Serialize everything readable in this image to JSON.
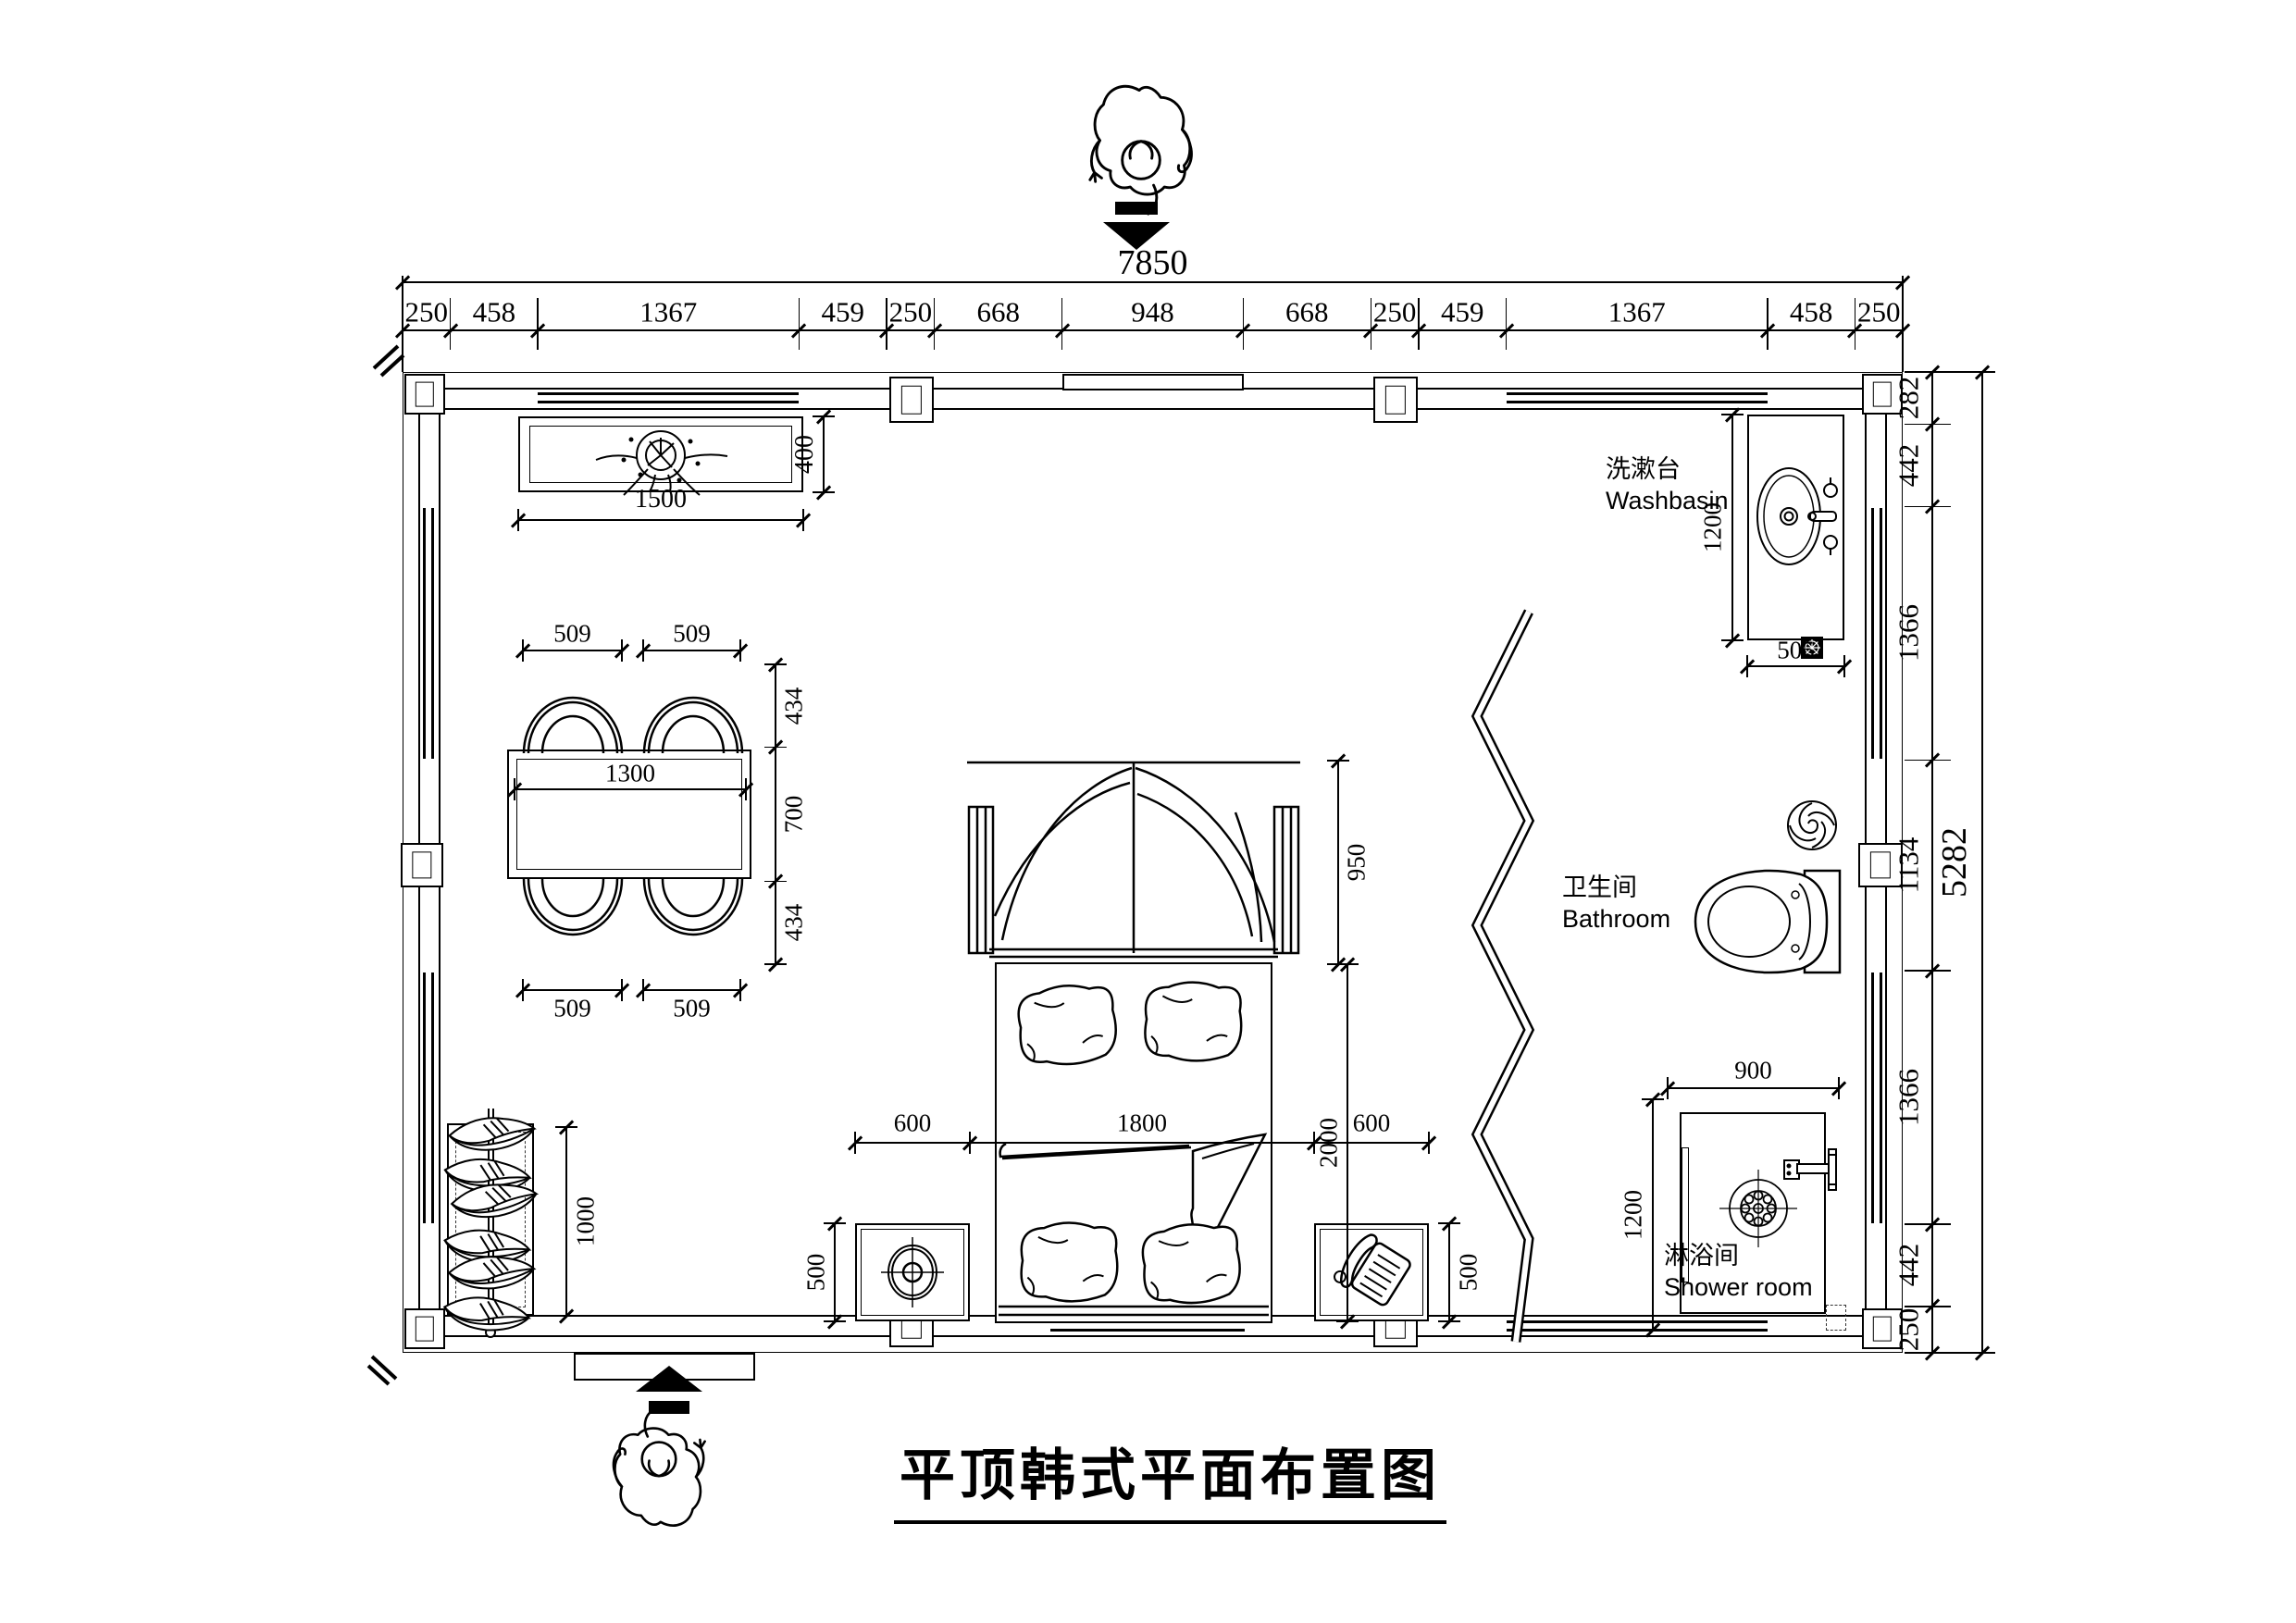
{
  "title": "平顶韩式平面布置图",
  "rooms": {
    "washbasin": {
      "zh": "洗漱台",
      "en": "Washbasin"
    },
    "bathroom": {
      "zh": "卫生间",
      "en": "Bathroom"
    },
    "shower": {
      "zh": "淋浴间",
      "en": "Shower room"
    }
  },
  "dims": {
    "top_total": "7850",
    "top_segments": [
      "250",
      "458",
      "1367",
      "459",
      "250",
      "668",
      "948",
      "668",
      "250",
      "459",
      "1367",
      "458",
      "250"
    ],
    "right_total": "5282",
    "right_segments": [
      "282",
      "442",
      "1366",
      "1134",
      "1366",
      "442",
      "250"
    ],
    "tv_width": "1500",
    "tv_depth": "400",
    "table_width": "1300",
    "chairs_top": [
      "509",
      "509"
    ],
    "chairs_bottom": [
      "509",
      "509"
    ],
    "dining_side": [
      "434",
      "700",
      "434"
    ],
    "bed_row": [
      "600",
      "1800",
      "600"
    ],
    "bed_length": "2000",
    "canopy_depth": "950",
    "nightstand_left": "500",
    "nightstand_right": "500",
    "wardrobe_width": "1000",
    "washbasin_depth": "1200",
    "washbasin_width": "505",
    "shower_width": "900",
    "shower_depth": "1200"
  }
}
